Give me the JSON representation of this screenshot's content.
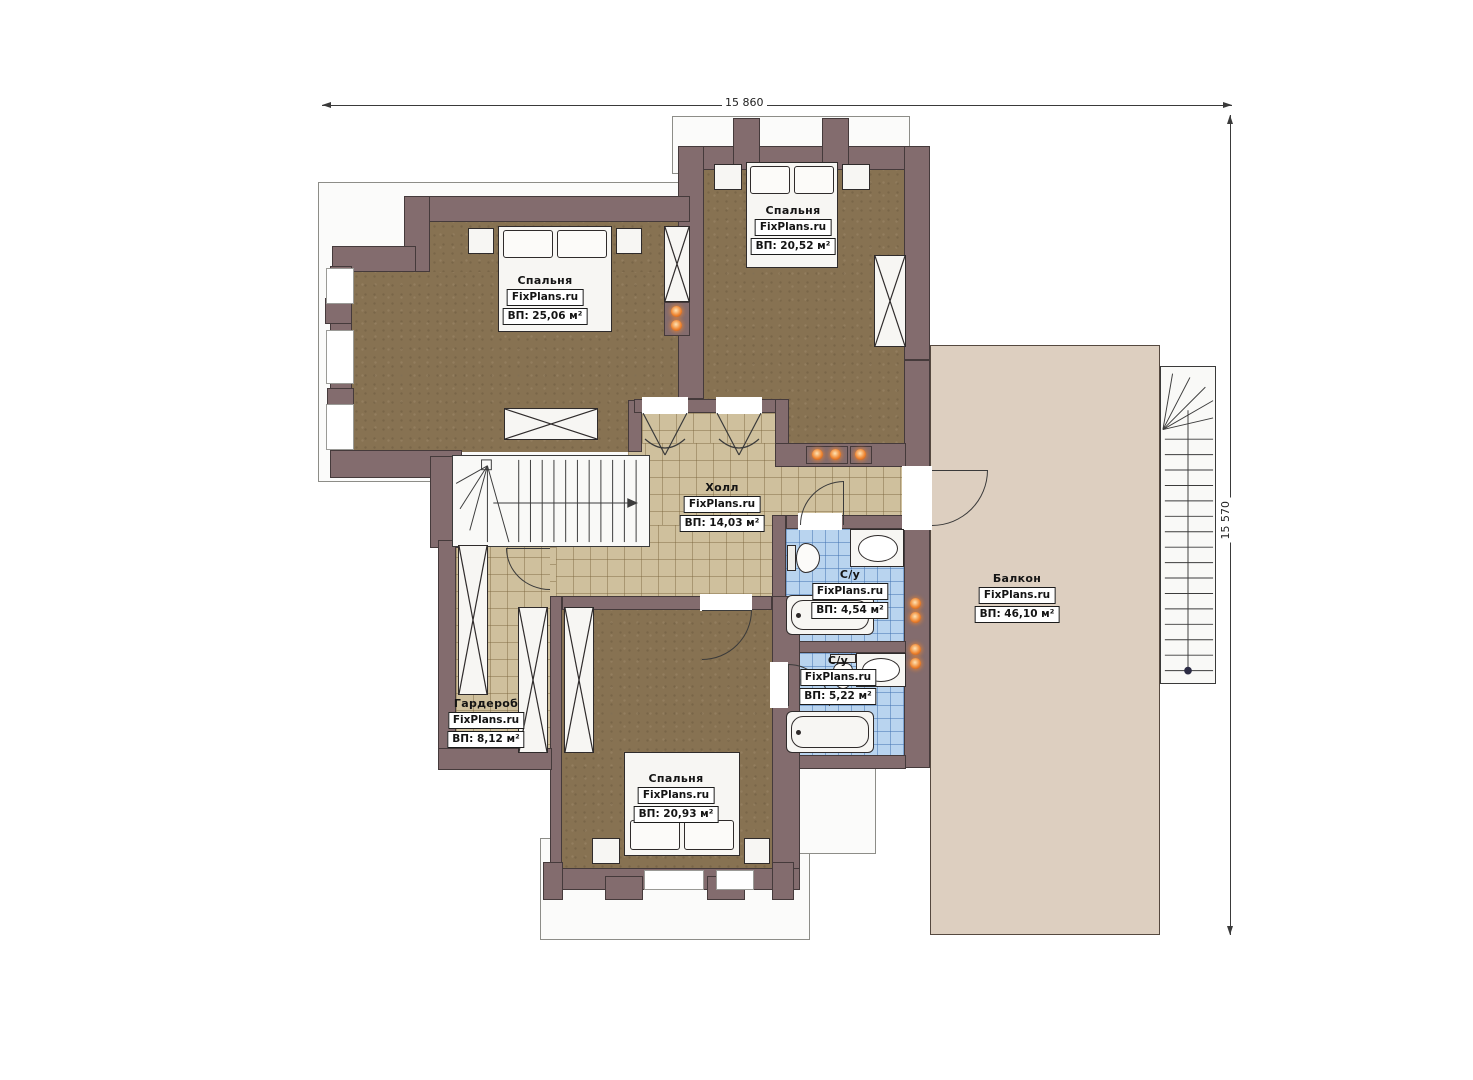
{
  "plan": {
    "dimension_width": "15 860",
    "dimension_height": "15 570"
  },
  "rooms": [
    {
      "id": "bedroom-left",
      "name": "Спальня",
      "site": "FixPlans.ru",
      "area": "ВП: 25,06 м²"
    },
    {
      "id": "bedroom-top",
      "name": "Спальня",
      "site": "FixPlans.ru",
      "area": "ВП: 20,52 м²"
    },
    {
      "id": "hall",
      "name": "Холл",
      "site": "FixPlans.ru",
      "area": "ВП: 14,03 м²"
    },
    {
      "id": "bathroom-1",
      "name": "С/у",
      "site": "FixPlans.ru",
      "area": "ВП: 4,54 м²"
    },
    {
      "id": "bathroom-2",
      "name": "С/у",
      "site": "FixPlans.ru",
      "area": "ВП: 5,22 м²"
    },
    {
      "id": "wardrobe",
      "name": "Гардероб",
      "site": "FixPlans.ru",
      "area": "ВП: 8,12 м²"
    },
    {
      "id": "bedroom-bottom",
      "name": "Спальня",
      "site": "FixPlans.ru",
      "area": "ВП: 20,93 м²"
    },
    {
      "id": "balcony",
      "name": "Балкон",
      "site": "FixPlans.ru",
      "area": "ВП: 46,10 м²"
    }
  ],
  "colors": {
    "wall": "#836c6e",
    "bedroom_floor": "#877252",
    "hall_tile": "#cfc09d",
    "bathroom_tile": "#b9d4ef",
    "balcony_floor": "#ddcfc0",
    "accent_dot": "#ef8632"
  }
}
